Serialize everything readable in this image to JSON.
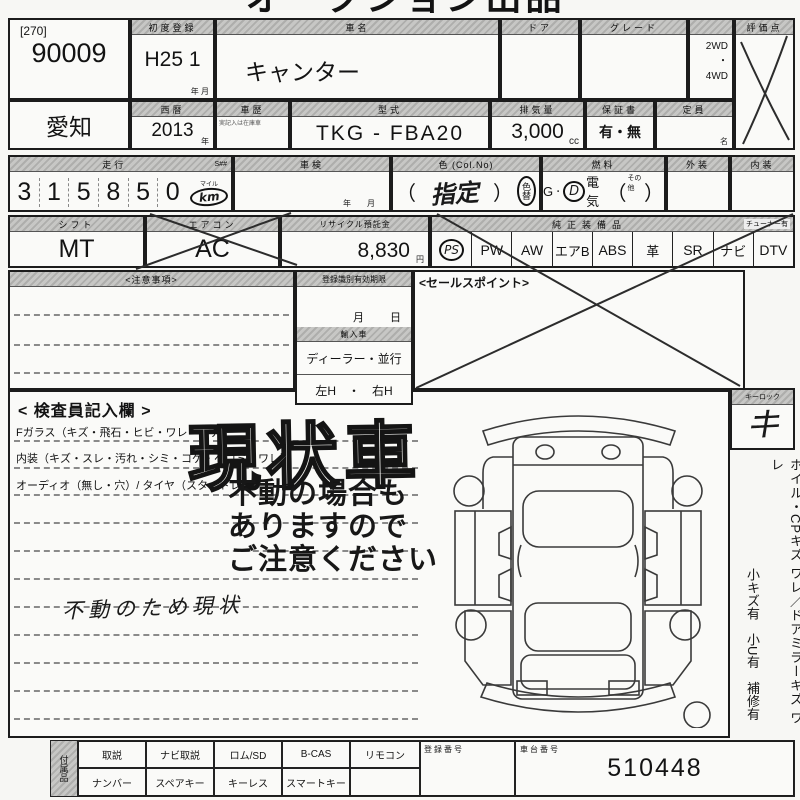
{
  "sheet": {
    "top_title": "オークション出品票",
    "lot": {
      "bracket": "[270]",
      "number": "90009"
    },
    "first_registration": {
      "label": "初度登録",
      "value": "H25 1",
      "unit": "年  月"
    },
    "car_name": {
      "label": "車名",
      "value": "キャンター"
    },
    "door": {
      "label": "ドア"
    },
    "grade": {
      "label": "グレード"
    },
    "drive": {
      "opt1": "2WD",
      "dot": "・",
      "opt2": "4WD"
    },
    "rating": {
      "label": "評価点"
    },
    "prefecture": "愛知",
    "calendar_year": {
      "label": "西暦",
      "value": "2013",
      "unit": "年"
    },
    "history": {
      "label": "車歴",
      "note": "実記入は在庫車"
    },
    "model_code": {
      "label": "型式",
      "value": "TKG - FBA20"
    },
    "displacement": {
      "label": "排気量",
      "value": "3,000",
      "unit": "cc"
    },
    "warranty": {
      "label": "保証書",
      "value": "有・無"
    },
    "capacity": {
      "label": "定員",
      "unit": "名"
    },
    "mileage": {
      "label": "走行",
      "s_label": "S##",
      "digits": [
        "3",
        "1",
        "5",
        "8",
        "5",
        "0"
      ],
      "mile_label": "マイル",
      "km_label": "km"
    },
    "shaken": {
      "label": "車検",
      "unit": "年　　月"
    },
    "color": {
      "label": "色 (Col.No)",
      "paren_open": "（",
      "value": "指定",
      "paren_close": "）",
      "color_change": "色替"
    },
    "fuel": {
      "label": "燃料",
      "g": "G",
      "dot": "・",
      "d": "D",
      "elec": "電気",
      "paren_open": "（",
      "other": "その他",
      "paren_close": "）"
    },
    "exterior": {
      "label": "外装"
    },
    "interior": {
      "label": "内装"
    },
    "shift": {
      "label": "シフト",
      "value": "MT"
    },
    "aircon": {
      "label": "エアコン",
      "value": "AC"
    },
    "recycle": {
      "label": "リサイクル預託金",
      "value": "8,830",
      "unit": "円"
    },
    "equipment": {
      "label": "純正装備品",
      "tuner_note": "チューナー有",
      "items": [
        "PS",
        "PW",
        "AW",
        "エアB",
        "ABS",
        "革",
        "SR",
        "ナビ",
        "DTV"
      ]
    },
    "caution": {
      "label": "<注意事項>"
    },
    "registration_validity": {
      "label": "登録識別有効期限",
      "month": "月",
      "day": "日",
      "import_label": "輸入車",
      "dealer": "ディーラー・並行",
      "handle": "左H　・　右H"
    },
    "sales_point": {
      "label": "<セールスポイント>"
    },
    "inspector": {
      "label": "< 検査員記入欄 >",
      "line1": "Fガラス（キズ・飛石・ヒビ・ワレ・要デ）",
      "line2": "内装（キズ・スレ・汚れ・シミ・コゲ・ヘコミ・ワレ）",
      "line3": "オーディオ（無し・穴）/ タイヤ（スタッドレス）",
      "stamp_main": "現状車",
      "stamp_warning": [
        "不動の場合も",
        "ありますので",
        "ご注意ください"
      ],
      "handwritten_note": "不動のため現状"
    },
    "right_strip": {
      "keylock_label": "キーロック",
      "keylock_mark": "キ",
      "vertical_note1": "ホイル・CPキズ ワレ／ドアミラーキズ ワレ",
      "vertical_note2": "小キズ有　小U有　補修有"
    },
    "bottom": {
      "attachments_label": "付属品",
      "row1": [
        "取説",
        "ナビ取説",
        "ロム/SD",
        "B-CAS",
        "リモコン"
      ],
      "row2": [
        "ナンバー",
        "スペアキー",
        "キーレス",
        "スマートキー"
      ],
      "reg_number_label": "登録番号",
      "chassis_label": "車台番号",
      "chassis_value": "510448"
    }
  }
}
